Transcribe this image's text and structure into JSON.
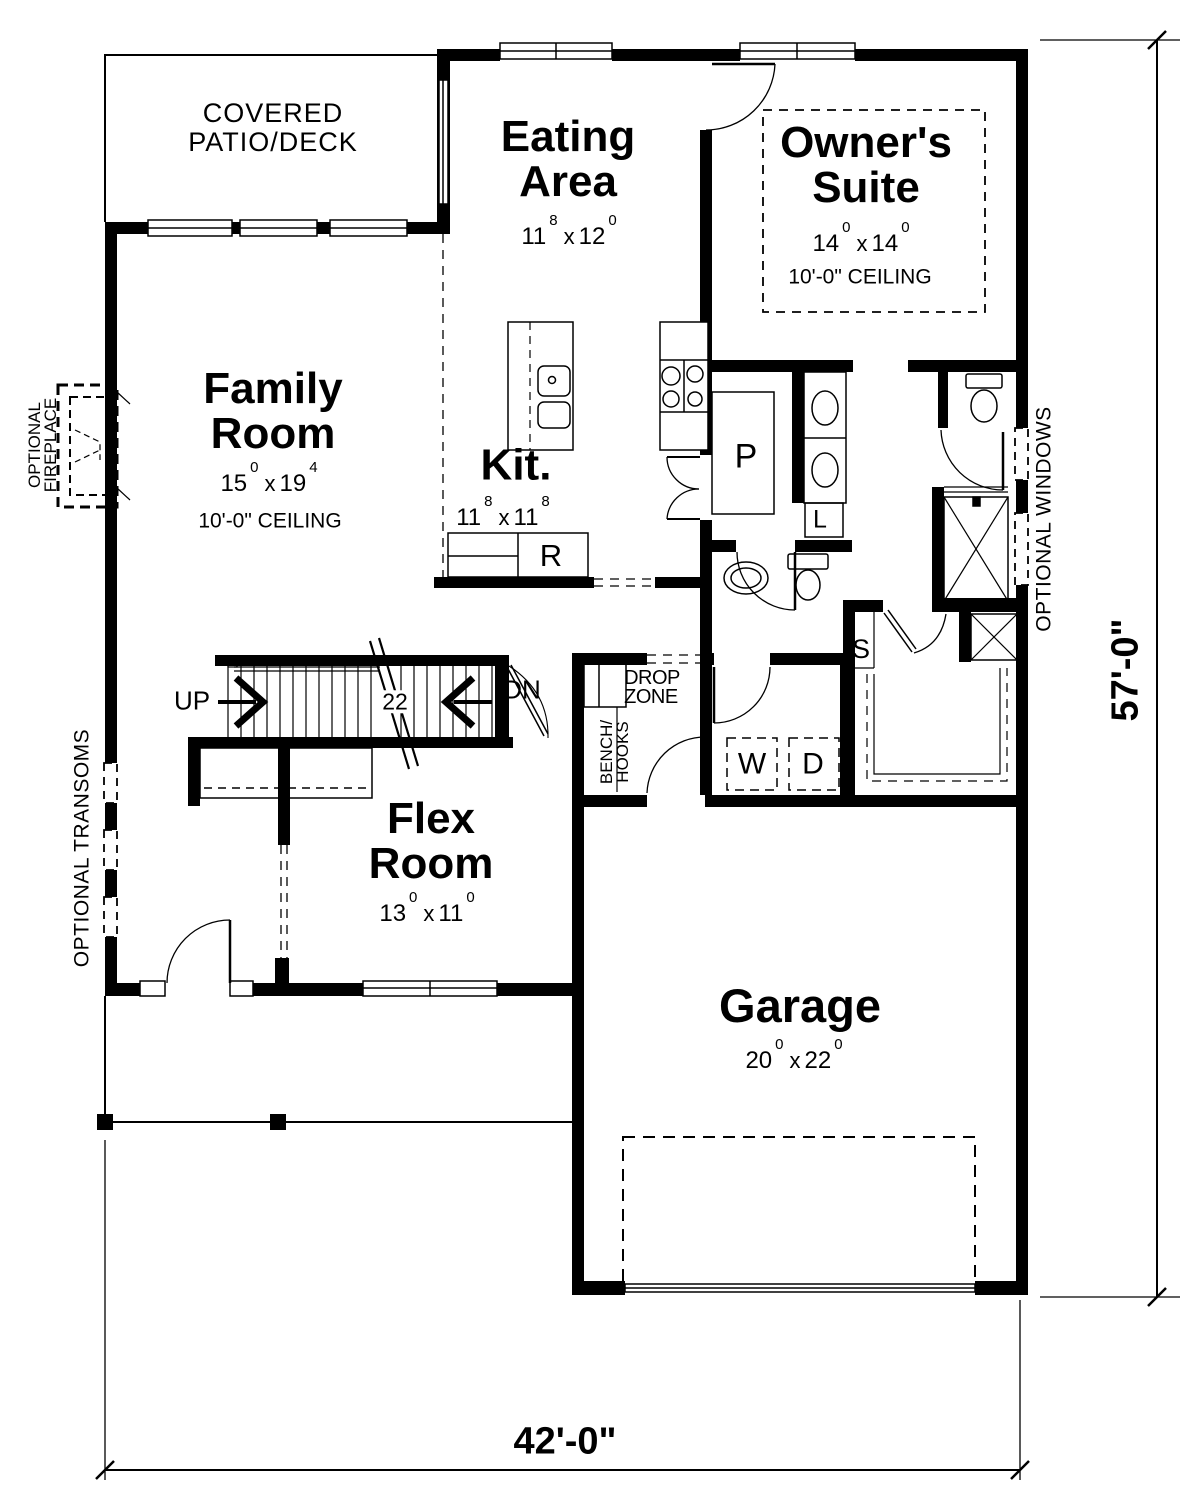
{
  "plan": {
    "rooms": {
      "patio": {
        "line1": "COVERED",
        "line2": "PATIO/DECK"
      },
      "eating": {
        "line1": "Eating",
        "line2": "Area",
        "dim": {
          "a": "11",
          "ae": "8",
          "x": "x",
          "b": "12",
          "be": "0"
        }
      },
      "owners": {
        "line1": "Owner's",
        "line2": "Suite",
        "dim": {
          "a": "14",
          "ae": "0",
          "x": "x",
          "b": "14",
          "be": "0"
        },
        "ceiling": "10'-0\" CEILING"
      },
      "family": {
        "line1": "Family",
        "line2": "Room",
        "dim": {
          "a": "15",
          "ae": "0",
          "x": "x",
          "b": "19",
          "be": "4"
        },
        "ceiling": "10'-0\" CEILING"
      },
      "kitchen": {
        "line1": "Kit.",
        "dim": {
          "a": "11",
          "ae": "8",
          "x": "x",
          "b": "11",
          "be": "8"
        }
      },
      "flex": {
        "line1": "Flex",
        "line2": "Room",
        "dim": {
          "a": "13",
          "ae": "0",
          "x": "x",
          "b": "11",
          "be": "0"
        }
      },
      "garage": {
        "line1": "Garage",
        "dim": {
          "a": "20",
          "ae": "0",
          "x": "x",
          "b": "22",
          "be": "0"
        }
      }
    },
    "stairs": {
      "up": "UP",
      "down": "DN",
      "risers": "22"
    },
    "labels": {
      "drop1": "DROP",
      "drop2": "ZONE",
      "bench1": "BENCH/",
      "bench2": "HOOKS",
      "washer": "W",
      "dryer": "D",
      "pantry": "P",
      "linen": "L",
      "shelf": "S",
      "range": "R",
      "fire1": "OPTIONAL",
      "fire2": "FIREPLACE",
      "transoms": "OPTIONAL TRANSOMS",
      "windows": "OPTIONAL WINDOWS"
    },
    "dimensions": {
      "width": "42'-0\"",
      "height": "57'-0\""
    },
    "colors": {
      "ink": "#000000",
      "paper": "#ffffff"
    }
  }
}
